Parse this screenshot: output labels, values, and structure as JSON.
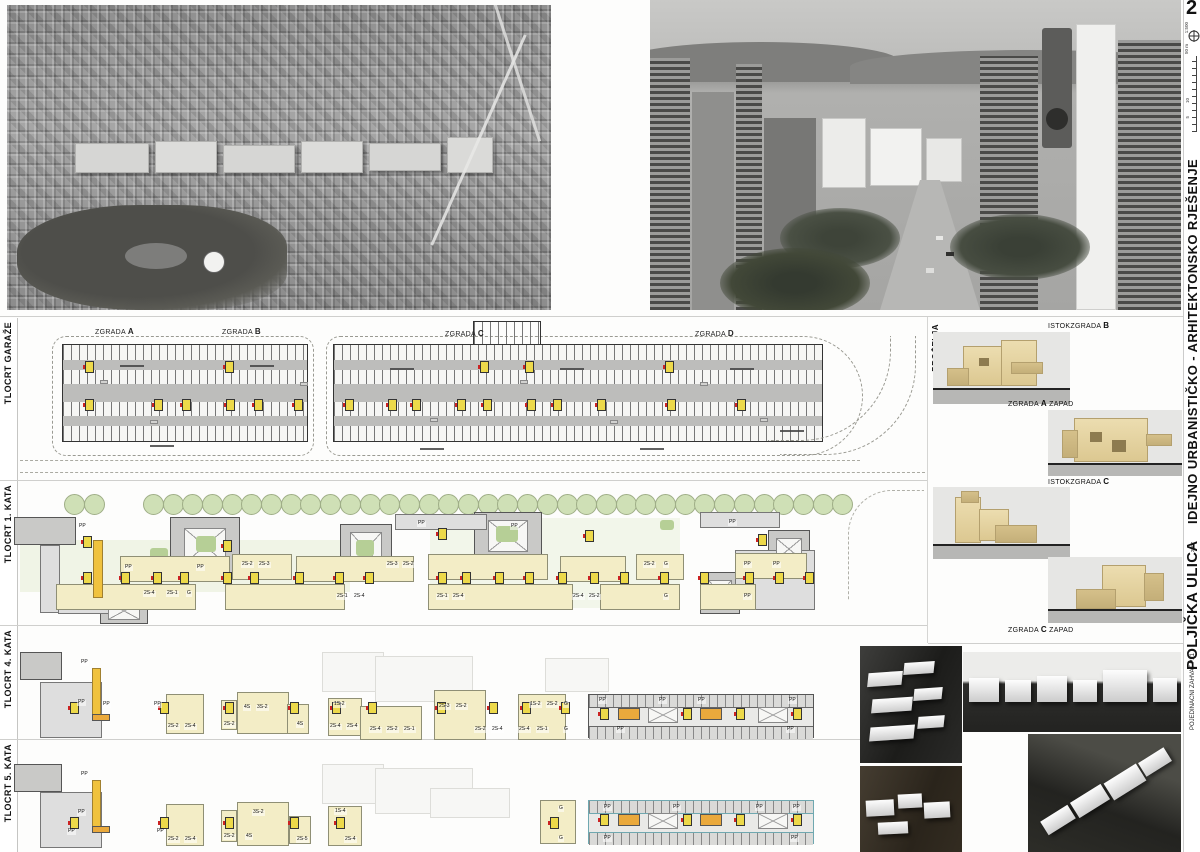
{
  "board": {
    "page_number": "2",
    "scale": {
      "ratio": "1:500",
      "length": "50 m",
      "ticks": [
        "5",
        "10"
      ]
    },
    "titles": {
      "project": "IDEJNO URBANISTIČKO - ARHITEKTONSKO RJEŠENJE",
      "street": "POLJIČKA ULICA",
      "year": "2007",
      "subtitle": "POJEDINAČNI ZAHVAT P21"
    }
  },
  "rows": {
    "garage": {
      "label": "TLOCRT GARAŽE",
      "buildings": [
        {
          "pre": "ZGRADA ",
          "bold": "A"
        },
        {
          "pre": "ZGRADA ",
          "bold": "B"
        },
        {
          "pre": "ZGRADA ",
          "bold": "C"
        },
        {
          "pre": "ZGRADA ",
          "bold": "D"
        }
      ]
    },
    "floor1": {
      "label": "TLOCRT 1. KATA",
      "units": [
        "PP",
        "PP",
        "PP",
        "2S-4",
        "2S-1",
        "G",
        "2S-2",
        "2S-3",
        "2S-3",
        "2S-2",
        "PP",
        "2S-1",
        "2S-4",
        "PP",
        "2S-1",
        "2S-4",
        "2S-4",
        "2S-2",
        "2S-2",
        "G",
        "G",
        "PP",
        "PP",
        "PP",
        "PP"
      ]
    },
    "floor4": {
      "label": "TLOCRT 4. KATA",
      "units": [
        "PP",
        "PP",
        "PP",
        "PP",
        "2S-2",
        "2S-4",
        "2S-2",
        "4S",
        "3S-2",
        "4S",
        "1S-2",
        "2S-4",
        "2S-4",
        "2S-4",
        "2S-2",
        "2S-1",
        "2S-3",
        "2S-2",
        "2S-2",
        "2S-4",
        "1S-2",
        "2S-2",
        "G",
        "2S-4",
        "2S-1",
        "G",
        "PP",
        "PP",
        "PP",
        "PP",
        "PP",
        "PP"
      ]
    },
    "floor5": {
      "label": "TLOCRT 5. KATA",
      "units": [
        "PP",
        "PP",
        "PP",
        "PP",
        "2S-2",
        "2S-4",
        "2S-2",
        "4S",
        "3S-2",
        "2S-5",
        "1S-4",
        "2S-4",
        "G",
        "G",
        "PP",
        "PP",
        "PP",
        "PP",
        "PP",
        "PP"
      ]
    }
  },
  "facades": {
    "label": "PROČELJA",
    "items": [
      {
        "pre": "ISTOK",
        "mid": "ZGRADA ",
        "bold": "B",
        "post": ""
      },
      {
        "pre": "",
        "mid": "ZGRADA ",
        "bold": "A",
        "post": " ZAPAD"
      },
      {
        "pre": "ISTOK",
        "mid": "ZGRADA ",
        "bold": "C",
        "post": ""
      },
      {
        "pre": "",
        "mid": "ZGRADA ",
        "bold": "C",
        "post": " ZAPAD"
      }
    ]
  }
}
